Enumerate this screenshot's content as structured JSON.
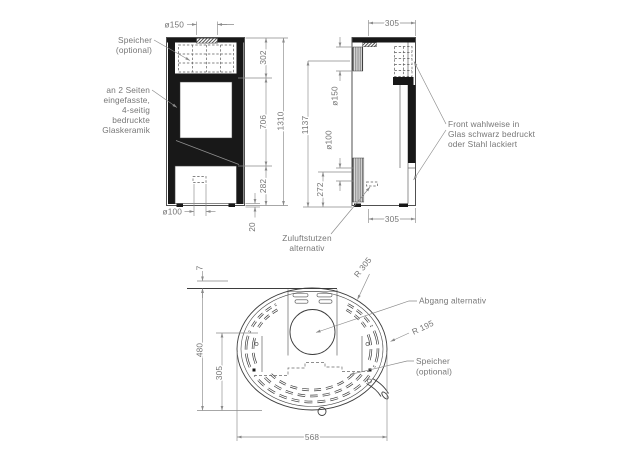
{
  "drawing_type": "technical-drawing-stove",
  "colors": {
    "object_line": "#3d3d3d",
    "dimension_line": "#8a8a8a",
    "text": "#767676",
    "solid_fill": "#181818",
    "background": "#ffffff"
  },
  "views": {
    "front": {
      "callouts": {
        "speicher_line1": "Speicher",
        "speicher_line2": "(optional)",
        "glass_line1": "an 2 Seiten",
        "glass_line2": "eingefasste,",
        "glass_line3": "4-seitig",
        "glass_line4": "bedruckte",
        "glass_line5": "Glaskeramik"
      },
      "dims": {
        "flue_top": "ø150",
        "upper": "302",
        "glass": "706",
        "base": "282",
        "total": "1310",
        "feet": "20",
        "inlet": "ø100"
      }
    },
    "side": {
      "callouts": {
        "front_line1": "Front wahlweise in",
        "front_line2": "Glas schwarz bedruckt",
        "front_line3": "oder Stahl lackiert",
        "zuluft_line1": "Zuluftstutzen",
        "zuluft_line2": "alternativ"
      },
      "dims": {
        "top_depth": "305",
        "bottom_depth": "305",
        "flue_rear": "ø150",
        "inlet_rear": "ø100",
        "flue_height": "1137",
        "inlet_height": "272"
      }
    },
    "top": {
      "callouts": {
        "abgang": "Abgang alternativ",
        "speicher_line1": "Speicher",
        "speicher_line2": "(optional)"
      },
      "dims": {
        "wall_gap": "7",
        "depth_total": "480",
        "depth_center": "305",
        "width": "568",
        "radius_body": "R 305",
        "radius_front": "R 195"
      }
    }
  }
}
